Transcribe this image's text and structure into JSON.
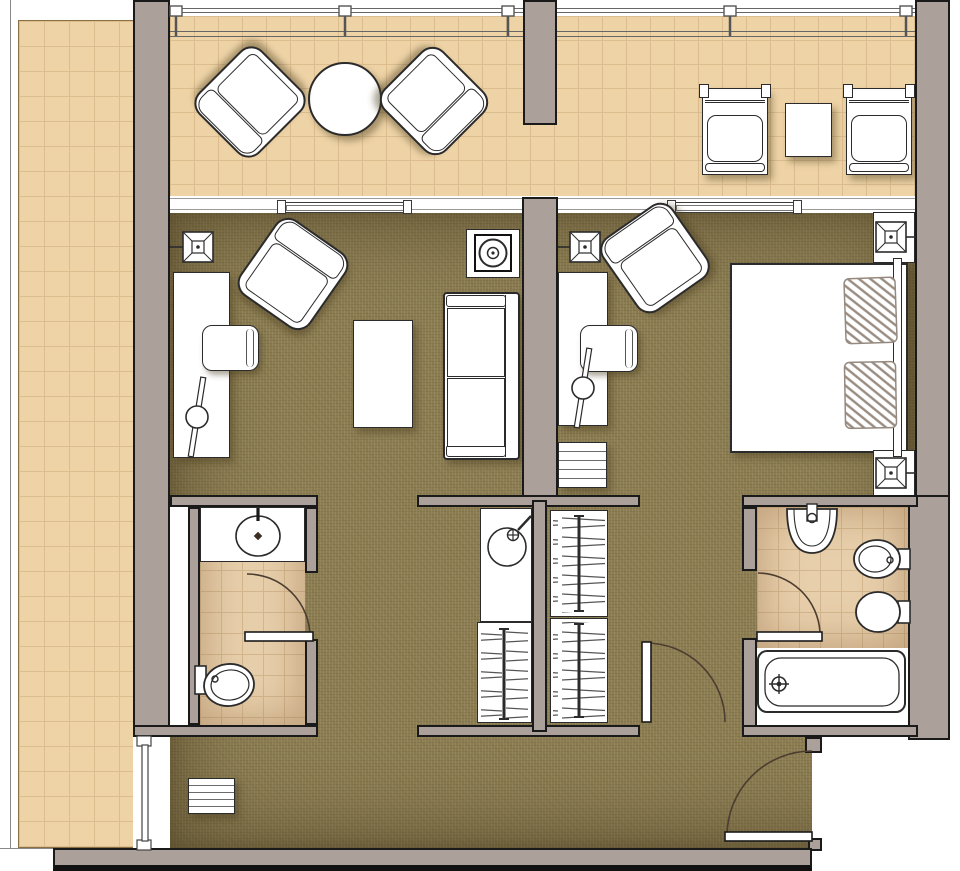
{
  "meta": {
    "type": "floor-plan",
    "view": "top-down",
    "description": "Hotel suite architectural floor plan with balconies, living room, bedroom, wardrobe core, powder room and bathroom"
  },
  "colors": {
    "wall_fill": "#aba09a",
    "wall_outline": "#1a1a1a",
    "balcony_tile": "#eed3a6",
    "balcony_tile_line": "#dcbd8e",
    "balcony_edge": "#8a6f47",
    "carpet": "#8d7e53",
    "bath_tile": "#e8cfab",
    "bath_tile_line": "#d4b78f",
    "furniture_fill": "#ffffff",
    "furniture_line": "#2b2b2b",
    "door_arc": "#4c3d31",
    "pillow_hatch": "#998c81",
    "railing_line": "#666666",
    "outside": "#ffffff"
  },
  "rooms": [
    {
      "name": "left-balcony",
      "floor": "tile",
      "items": [
        "railing"
      ]
    },
    {
      "name": "terrace",
      "floor": "tile",
      "items": [
        "railing",
        "railing-posts-x5",
        "armchair",
        "round-table",
        "armchair",
        "lounge-chair",
        "side-table",
        "lounge-chair"
      ]
    },
    {
      "name": "living-room",
      "floor": "carpet",
      "items": [
        "wall-light",
        "desk",
        "desk-chair",
        "desk-lamp",
        "armchair",
        "coffee-table",
        "sofa",
        "tv-console"
      ]
    },
    {
      "name": "bedroom",
      "floor": "carpet",
      "items": [
        "wall-light",
        "desk",
        "desk-chair",
        "desk-lamp",
        "dresser",
        "armchair",
        "double-bed",
        "pillow",
        "pillow",
        "headboard",
        "nightstand",
        "table-lamp",
        "nightstand",
        "table-lamp"
      ]
    },
    {
      "name": "wardrobe-core",
      "floor": "none",
      "items": [
        "wet-bar-sink",
        "closet-hangers",
        "closet-hangers",
        "closet-hangers"
      ]
    },
    {
      "name": "powder-room",
      "floor": "tile",
      "items": [
        "vanity-sink",
        "toilet",
        "swing-door",
        "service-shaft"
      ]
    },
    {
      "name": "bathroom",
      "floor": "tile",
      "items": [
        "sink",
        "bidet",
        "toilet",
        "bathtub",
        "swing-door"
      ]
    },
    {
      "name": "entry-hall",
      "floor": "carpet",
      "items": [
        "dresser",
        "entry-door",
        "bedroom-door",
        "balcony-sliding-door"
      ]
    }
  ],
  "door_count": 5,
  "window_sill_count": 2
}
